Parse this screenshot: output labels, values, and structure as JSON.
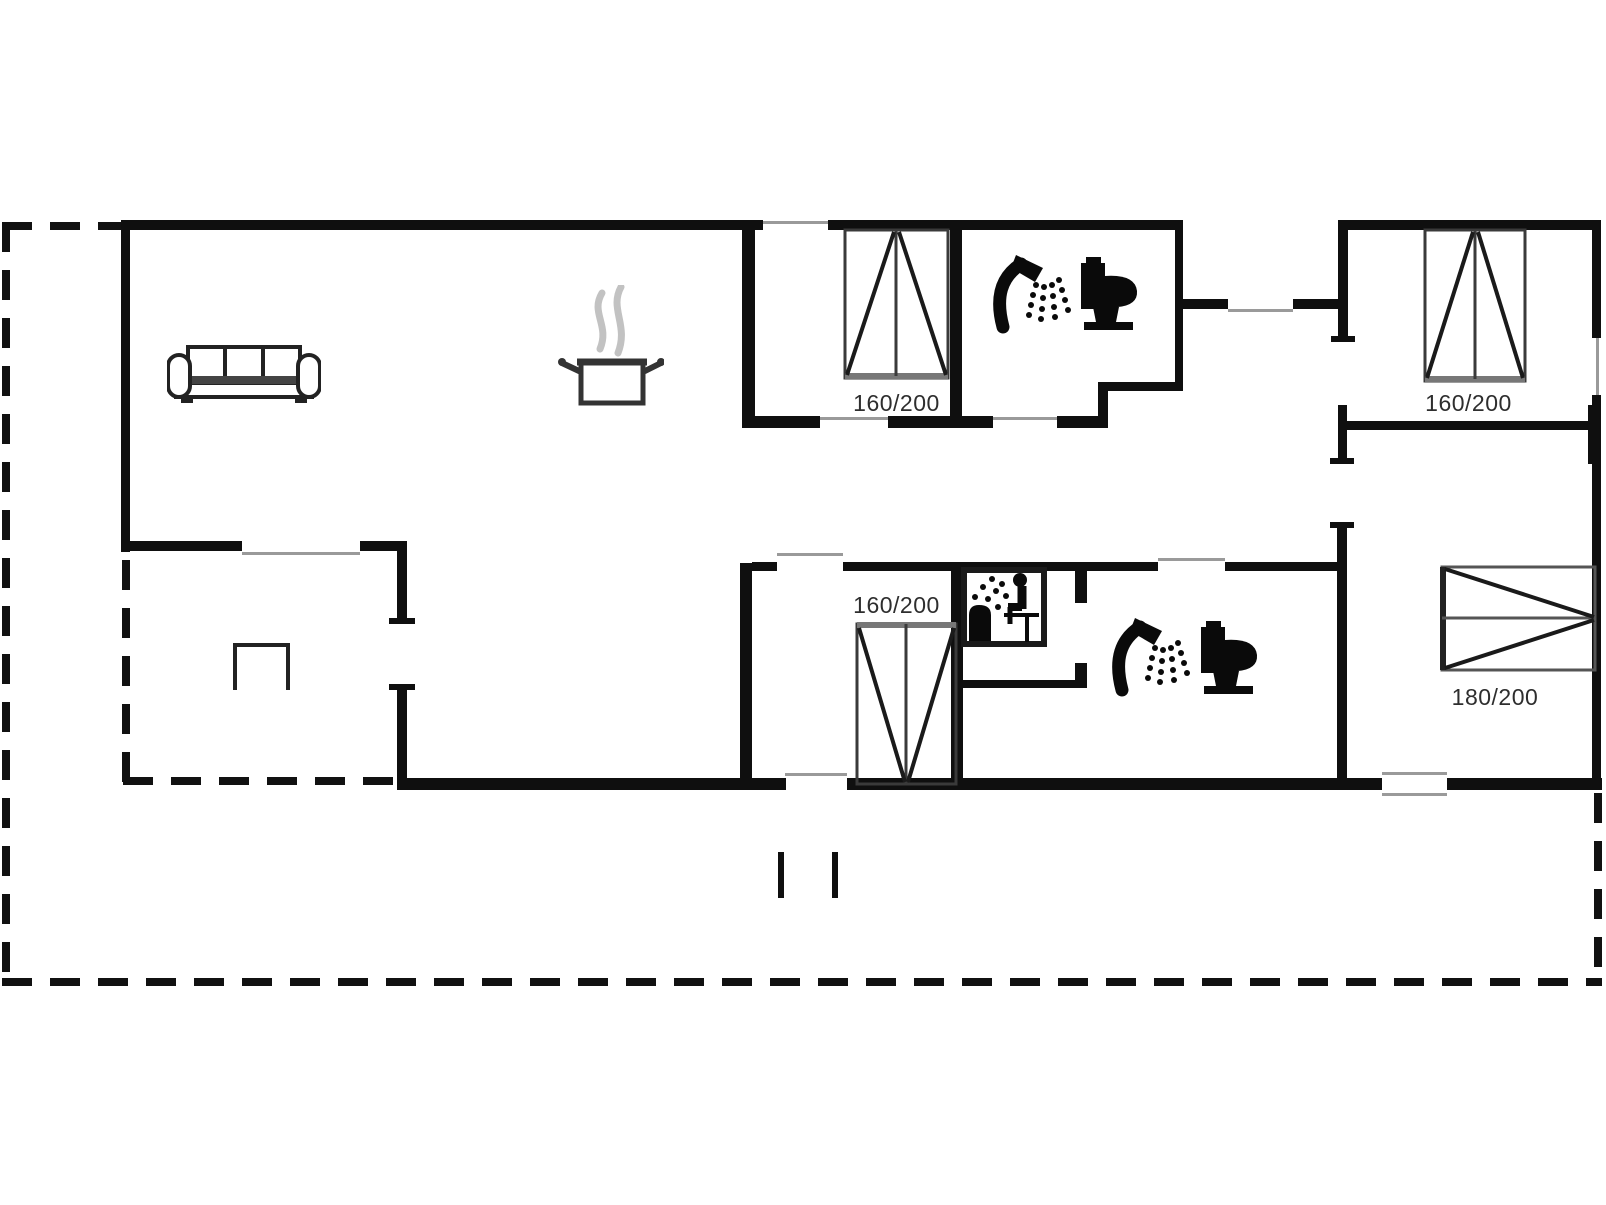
{
  "title": "holiday-house-floor-plan",
  "beds": [
    {
      "id": "bed-top-middle",
      "label": "160/200"
    },
    {
      "id": "bed-top-right",
      "label": "160/200"
    },
    {
      "id": "bed-bottom-middle",
      "label": "160/200"
    },
    {
      "id": "bed-bottom-right",
      "label": "180/200"
    }
  ],
  "icons": [
    "sofa-icon",
    "cooking-pot-icon",
    "shower-icon",
    "toilet-icon",
    "sauna-icon",
    "shower-icon",
    "toilet-icon"
  ],
  "colors": {
    "background": "#ffffff",
    "wall": "#0f0f0f",
    "opening_line": "#9a9a9a",
    "bed_outline": "#3a3a3a",
    "bed_foot": "#777777",
    "steam": "#c2c2c2",
    "label_text": "#2e2e2e"
  }
}
